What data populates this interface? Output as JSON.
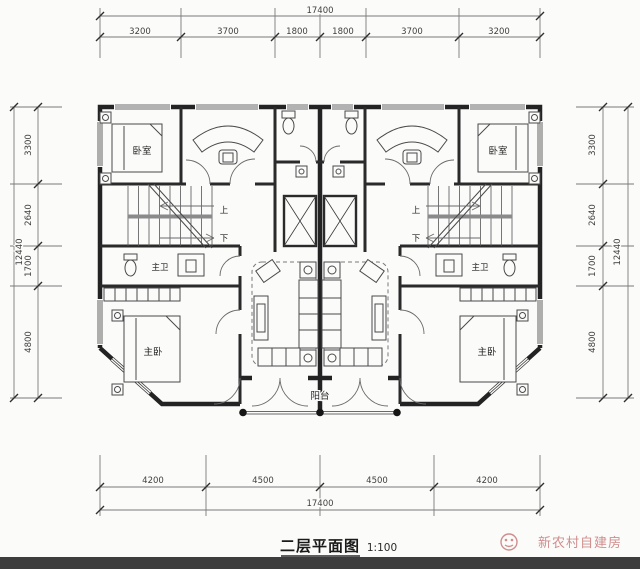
{
  "drawing": {
    "title": "二层平面图",
    "scale": "1:100",
    "watermark_text": "新农村自建房"
  },
  "dimensions": {
    "top": {
      "total": "17400",
      "segments": [
        "3200",
        "3700",
        "1800",
        "1800",
        "3700",
        "3200"
      ]
    },
    "bottom": {
      "total": "17400",
      "segments": [
        "4200",
        "4500",
        "4500",
        "4200"
      ]
    },
    "left": {
      "total": "12440",
      "segments": [
        "3300",
        "2640",
        "1700",
        "4800"
      ]
    },
    "right": {
      "total": "12440",
      "segments": [
        "3300",
        "2640",
        "1700",
        "4800"
      ]
    }
  },
  "rooms": {
    "bedroom": "卧室",
    "master_bedroom": "主卧",
    "master_bath": "主卫",
    "balcony": "阳台",
    "stair_up": "上",
    "stair_down": "下"
  },
  "colors": {
    "wall": "#232323",
    "dimension_line": "#7a7a7a",
    "watermark": "#cf8e8d",
    "bottom_bar": "#3d3d3d",
    "paper": "#fbfbfa"
  }
}
